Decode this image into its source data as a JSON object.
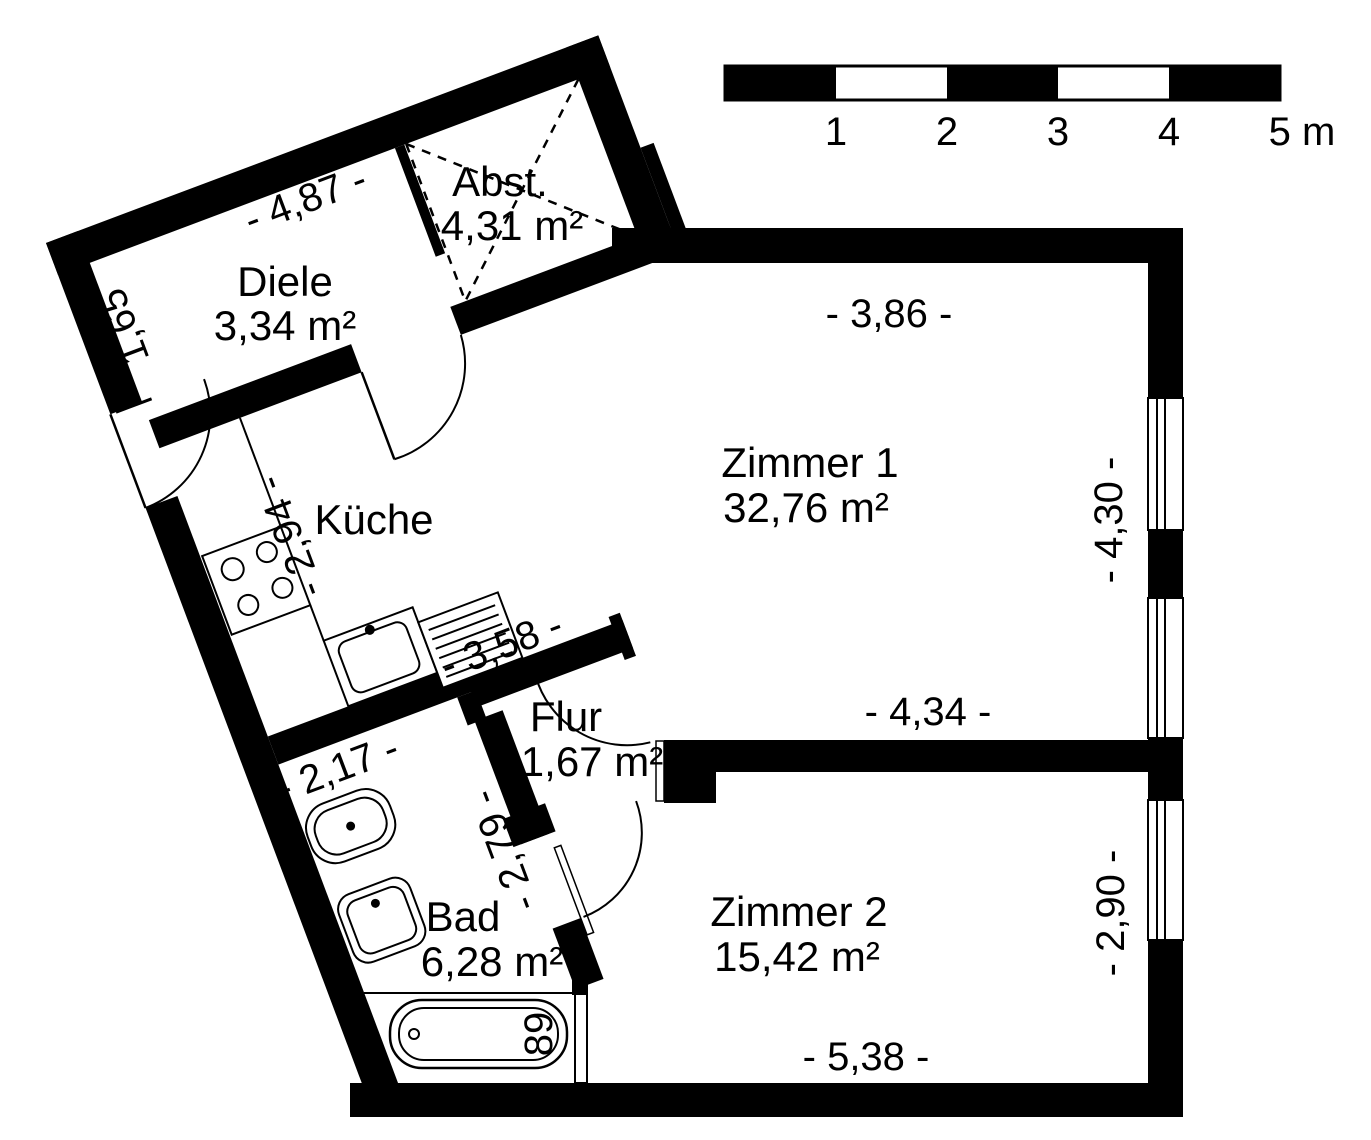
{
  "plan": {
    "title_none": "",
    "wall_color": "#000000",
    "background_color": "#ffffff",
    "rooms": [
      {
        "name": "Diele",
        "area": "3,34 m²"
      },
      {
        "name": "Abst.",
        "area": "4,31 m²"
      },
      {
        "name": "Küche",
        "area": ""
      },
      {
        "name": "Zimmer 1",
        "area": "32,76 m²"
      },
      {
        "name": "Flur",
        "area": "1,67 m²"
      },
      {
        "name": "Bad",
        "area": "6,28 m²"
      },
      {
        "name": "Zimmer 2",
        "area": "15,42 m²"
      }
    ],
    "dimensions": [
      {
        "id": "wing-top",
        "text": "- 4,87 -"
      },
      {
        "id": "entrance-wall",
        "text": "1,65"
      },
      {
        "id": "kitchen-depth",
        "text": "- 2,94 -"
      },
      {
        "id": "kitchen-width",
        "text": "- 3,58 -"
      },
      {
        "id": "bad-width",
        "text": "- 2,17 -"
      },
      {
        "id": "bad-depth",
        "text": "- 2,79 -"
      },
      {
        "id": "zimmer1-top",
        "text": "- 3,86 -"
      },
      {
        "id": "zimmer1-right",
        "text": "- 4,30 -"
      },
      {
        "id": "zimmer1-bottom",
        "text": "- 4,34 -"
      },
      {
        "id": "zimmer2-right",
        "text": "- 2,90 -"
      },
      {
        "id": "zimmer2-bottom",
        "text": "- 5,38 -"
      },
      {
        "id": "bathtub-width",
        "text": "89"
      }
    ],
    "scale_bar": {
      "labels": [
        "1",
        "2",
        "3",
        "4",
        "5 m"
      ]
    },
    "fixtures": [
      "stove",
      "sink",
      "drainboard",
      "toilet",
      "washbasin",
      "bathtub"
    ]
  }
}
